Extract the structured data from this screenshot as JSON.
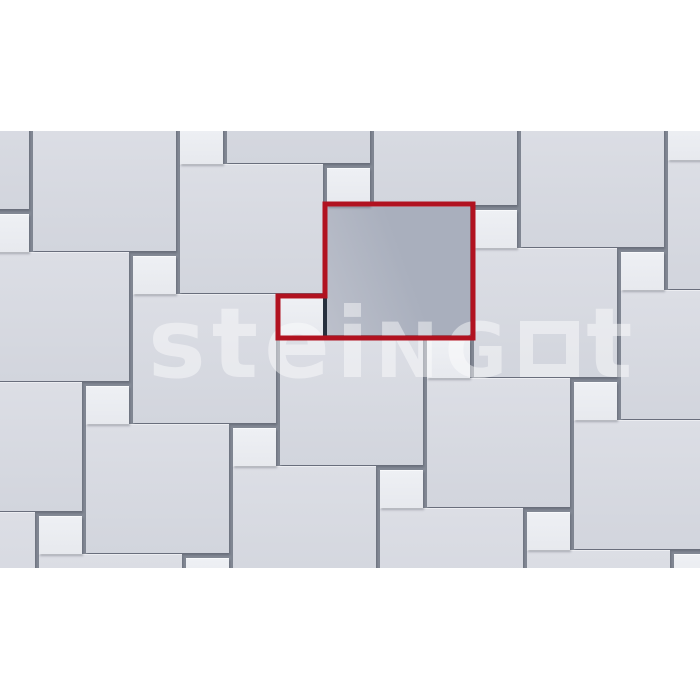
{
  "page": {
    "width": 700,
    "height": 700,
    "background": "#ffffff"
  },
  "content": {
    "top": 131,
    "height": 437
  },
  "colors": {
    "grout": "#838995",
    "big_tile": "#d2d5dd",
    "big_tile_light": "#dcdee5",
    "small_tile": "#e7e9ee",
    "small_tile_light": "#eef0f4",
    "highlight_fill": "#a9afbd",
    "highlight_fill_light": "#bcc0cb",
    "red_outline": "#b11220",
    "inner_joint": "#27303e",
    "watermark": "#ffffff"
  },
  "watermark": {
    "part1": "stei",
    "part2": "NG",
    "square_icon": "square-outline",
    "part3": "t"
  },
  "pattern": {
    "description": "paving layout of large slabs with small inset slabs, pinwheel offset; one module highlighted in red",
    "big": {
      "w": 143,
      "h": 129
    },
    "small": {
      "w": 43,
      "h": 38
    },
    "joint": 4,
    "tiles": [
      {
        "type": "big",
        "x": 227,
        "y": -97
      },
      {
        "type": "big",
        "x": 374,
        "y": -55
      },
      {
        "type": "big",
        "x": 521,
        "y": -13
      },
      {
        "type": "big",
        "x": 668,
        "y": 29
      },
      {
        "type": "big",
        "x": -114,
        "y": -51
      },
      {
        "type": "big",
        "x": 33,
        "y": -9
      },
      {
        "type": "big",
        "x": 180,
        "y": 33
      },
      {
        "type": "big-highlight",
        "x": 327,
        "y": 75
      },
      {
        "type": "big",
        "x": 474,
        "y": 117
      },
      {
        "type": "big",
        "x": 621,
        "y": 159
      },
      {
        "type": "big",
        "x": -14,
        "y": 121
      },
      {
        "type": "big",
        "x": 133,
        "y": 163
      },
      {
        "type": "big",
        "x": 280,
        "y": 205
      },
      {
        "type": "big",
        "x": 427,
        "y": 247
      },
      {
        "type": "big",
        "x": 574,
        "y": 289
      },
      {
        "type": "big",
        "x": -61,
        "y": 251
      },
      {
        "type": "big",
        "x": 86,
        "y": 293
      },
      {
        "type": "big",
        "x": 233,
        "y": 335
      },
      {
        "type": "big",
        "x": 380,
        "y": 377
      },
      {
        "type": "big",
        "x": 527,
        "y": 419
      },
      {
        "type": "big",
        "x": -108,
        "y": 381
      },
      {
        "type": "big",
        "x": 39,
        "y": 423
      },
      {
        "type": "small",
        "x": 180,
        "y": -5
      },
      {
        "type": "small",
        "x": 327,
        "y": 37
      },
      {
        "type": "small",
        "x": 474,
        "y": 79
      },
      {
        "type": "small",
        "x": 621,
        "y": 121
      },
      {
        "type": "small",
        "x": 668,
        "y": -9
      },
      {
        "type": "small",
        "x": -14,
        "y": 83
      },
      {
        "type": "small",
        "x": 133,
        "y": 125
      },
      {
        "type": "small",
        "x": 280,
        "y": 167
      },
      {
        "type": "small",
        "x": 427,
        "y": 209
      },
      {
        "type": "small",
        "x": 574,
        "y": 251
      },
      {
        "type": "small",
        "x": 86,
        "y": 255
      },
      {
        "type": "small",
        "x": 233,
        "y": 297
      },
      {
        "type": "small",
        "x": 380,
        "y": 339
      },
      {
        "type": "small",
        "x": 527,
        "y": 381
      },
      {
        "type": "small",
        "x": 674,
        "y": 423
      },
      {
        "type": "small",
        "x": 39,
        "y": 385
      },
      {
        "type": "small",
        "x": 186,
        "y": 427
      }
    ]
  },
  "highlight": {
    "outline_path": "M325,73 H473 V207 H278 V165 H325 Z",
    "inner_joint_path": "M325,167 V207"
  }
}
